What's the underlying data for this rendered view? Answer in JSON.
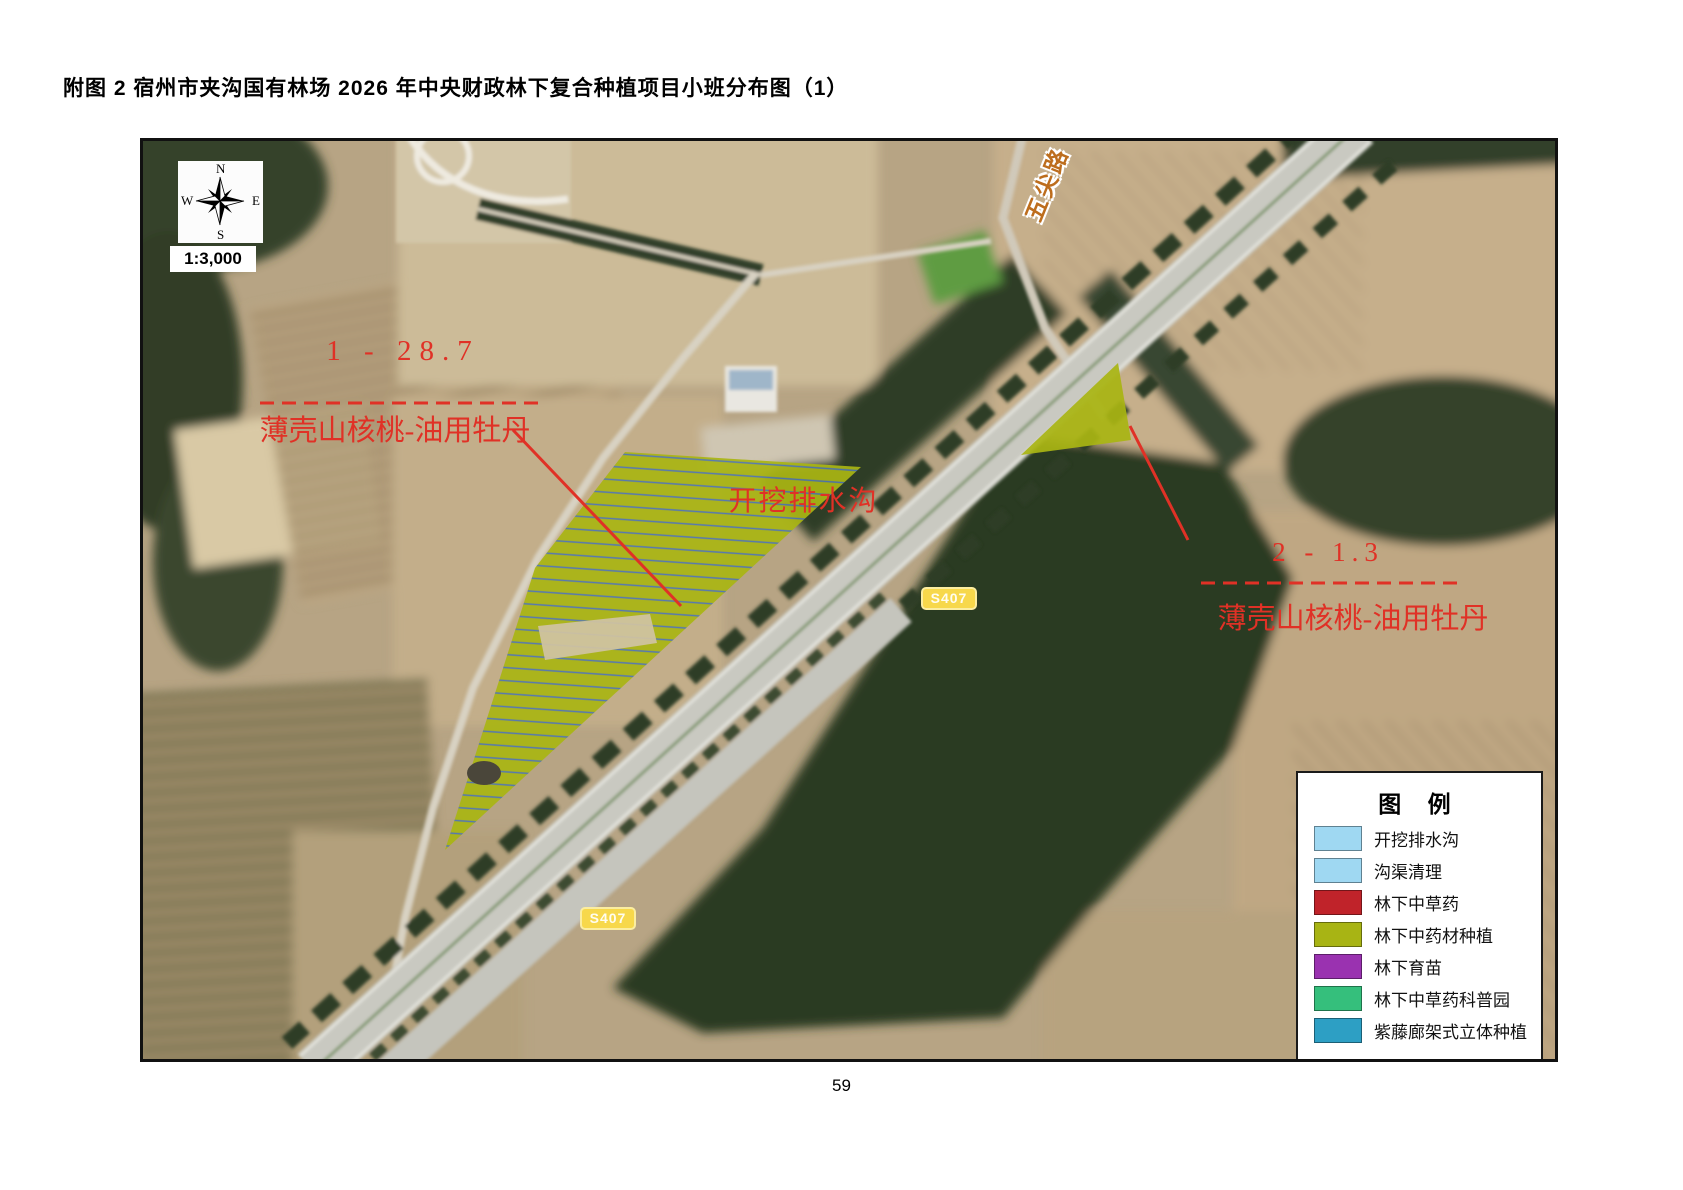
{
  "page": {
    "title": "附图 2 宿州市夹沟国有林场 2026 年中央财政林下复合种植项目小班分布图（1）",
    "page_number": "59"
  },
  "map": {
    "scale_text": "1:3,000",
    "compass": {
      "north": "N",
      "south": "S",
      "east": "E",
      "west": "W"
    },
    "road_labels": {
      "vertical_road": "五尖路",
      "route_badge_upper": "S407",
      "route_badge_lower": "S407"
    },
    "annotations": {
      "plot1_code": "1 - 28.7",
      "plot1_species": "薄壳山核桃-油用牡丹",
      "plot2_code": "2 - 1.3",
      "plot2_species": "薄壳山核桃-油用牡丹",
      "ditch_label": "开挖排水沟"
    },
    "colors": {
      "plot_fill_olive": "#a9b513",
      "annotation_red": "#e03126",
      "ditch_hatch_blue": "#4d74b5",
      "route_badge_yellow": "#f7d84b"
    }
  },
  "legend": {
    "title": "图  例",
    "items": [
      {
        "label": "开挖排水沟",
        "color": "#9fd8f2"
      },
      {
        "label": "沟渠清理",
        "color": "#9fd8f2"
      },
      {
        "label": "林下中草药",
        "color": "#c0232a"
      },
      {
        "label": "林下中药材种植",
        "color": "#a8b414"
      },
      {
        "label": "林下育苗",
        "color": "#9a32b0"
      },
      {
        "label": "林下中草药科普园",
        "color": "#35bf7c"
      },
      {
        "label": "紫藤廊架式立体种植",
        "color": "#2d9fc4"
      }
    ]
  }
}
